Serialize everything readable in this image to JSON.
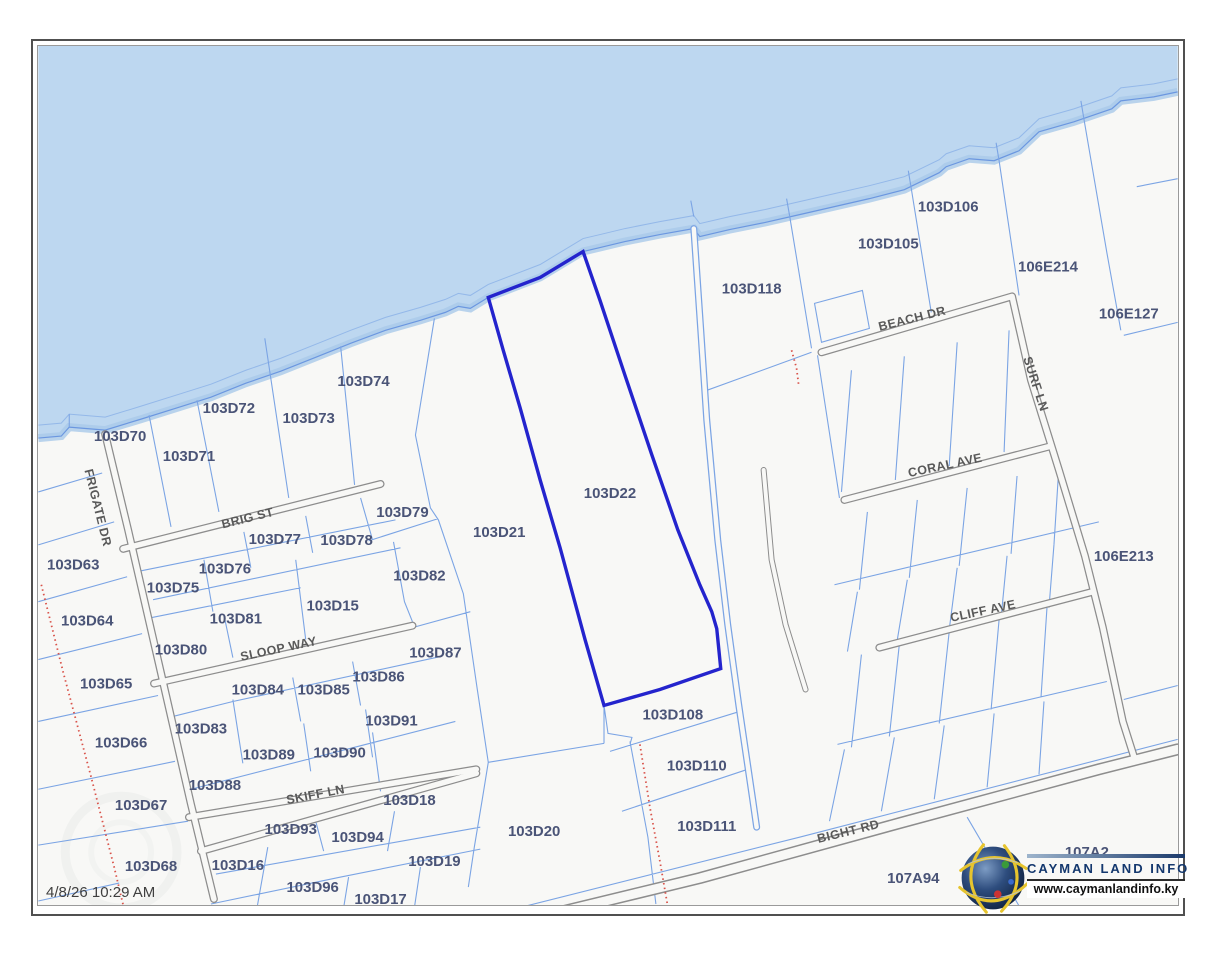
{
  "map": {
    "timestamp": "4/8/26 10:29 AM",
    "highlighted_parcel": "103D22",
    "colors": {
      "water": "#bdd7f0",
      "land": "#f8f8f6",
      "parcel_line": "#7ba4e4",
      "highlight_outline": "#2424cd",
      "road_casing": "#8d8d8d",
      "boundary_dotted": "#d9534a",
      "parcel_label": "#4a5477",
      "road_label": "#595959"
    },
    "parcel_labels": [
      {
        "id": "103D63",
        "x": 72,
        "y": 566
      },
      {
        "id": "103D64",
        "x": 86,
        "y": 622
      },
      {
        "id": "103D65",
        "x": 105,
        "y": 685
      },
      {
        "id": "103D66",
        "x": 120,
        "y": 744
      },
      {
        "id": "103D67",
        "x": 140,
        "y": 807
      },
      {
        "id": "103D68",
        "x": 150,
        "y": 868
      },
      {
        "id": "103D70",
        "x": 119,
        "y": 437
      },
      {
        "id": "103D71",
        "x": 188,
        "y": 457
      },
      {
        "id": "103D72",
        "x": 228,
        "y": 409
      },
      {
        "id": "103D73",
        "x": 308,
        "y": 419
      },
      {
        "id": "103D74",
        "x": 363,
        "y": 382
      },
      {
        "id": "103D75",
        "x": 172,
        "y": 589
      },
      {
        "id": "103D76",
        "x": 224,
        "y": 570
      },
      {
        "id": "103D77",
        "x": 274,
        "y": 540
      },
      {
        "id": "103D78",
        "x": 346,
        "y": 541
      },
      {
        "id": "103D79",
        "x": 402,
        "y": 513
      },
      {
        "id": "103D80",
        "x": 180,
        "y": 651
      },
      {
        "id": "103D81",
        "x": 235,
        "y": 620
      },
      {
        "id": "103D82",
        "x": 419,
        "y": 577
      },
      {
        "id": "103D15",
        "x": 332,
        "y": 607
      },
      {
        "id": "103D87",
        "x": 435,
        "y": 654
      },
      {
        "id": "103D86",
        "x": 378,
        "y": 678
      },
      {
        "id": "103D84",
        "x": 257,
        "y": 691
      },
      {
        "id": "103D85",
        "x": 323,
        "y": 691
      },
      {
        "id": "103D91",
        "x": 391,
        "y": 722
      },
      {
        "id": "103D83",
        "x": 200,
        "y": 730
      },
      {
        "id": "103D89",
        "x": 268,
        "y": 756
      },
      {
        "id": "103D90",
        "x": 339,
        "y": 754
      },
      {
        "id": "103D88",
        "x": 214,
        "y": 787
      },
      {
        "id": "103D18",
        "x": 409,
        "y": 802
      },
      {
        "id": "103D93",
        "x": 290,
        "y": 831
      },
      {
        "id": "103D94",
        "x": 357,
        "y": 839
      },
      {
        "id": "103D16",
        "x": 237,
        "y": 867
      },
      {
        "id": "103D19",
        "x": 434,
        "y": 863
      },
      {
        "id": "103D96",
        "x": 312,
        "y": 889
      },
      {
        "id": "103D17",
        "x": 380,
        "y": 901
      },
      {
        "id": "103D21",
        "x": 499,
        "y": 533
      },
      {
        "id": "103D22",
        "x": 610,
        "y": 494
      },
      {
        "id": "103D20",
        "x": 534,
        "y": 833
      },
      {
        "id": "103D108",
        "x": 673,
        "y": 716
      },
      {
        "id": "103D110",
        "x": 697,
        "y": 767
      },
      {
        "id": "103D111",
        "x": 707,
        "y": 828
      },
      {
        "id": "103D118",
        "x": 752,
        "y": 289
      },
      {
        "id": "103D105",
        "x": 889,
        "y": 244
      },
      {
        "id": "103D106",
        "x": 949,
        "y": 207
      },
      {
        "id": "106E214",
        "x": 1049,
        "y": 267
      },
      {
        "id": "106E127",
        "x": 1130,
        "y": 314
      },
      {
        "id": "106E213",
        "x": 1125,
        "y": 557
      },
      {
        "id": "107A94",
        "x": 914,
        "y": 880
      },
      {
        "id": "107A2",
        "x": 1088,
        "y": 854
      }
    ],
    "road_labels": [
      {
        "name": "FRIGATE DR",
        "x": 96,
        "y": 508,
        "angle": 76
      },
      {
        "name": "BRIG ST",
        "x": 247,
        "y": 519,
        "angle": -14
      },
      {
        "name": "SLOOP WAY",
        "x": 278,
        "y": 650,
        "angle": -12
      },
      {
        "name": "SKIFF LN",
        "x": 315,
        "y": 796,
        "angle": -11
      },
      {
        "name": "BEACH DR",
        "x": 913,
        "y": 319,
        "angle": -14
      },
      {
        "name": "SURF LN",
        "x": 1036,
        "y": 384,
        "angle": 72
      },
      {
        "name": "CORAL AVE",
        "x": 946,
        "y": 466,
        "angle": -12
      },
      {
        "name": "CLIFF AVE",
        "x": 984,
        "y": 612,
        "angle": -12
      },
      {
        "name": "BIGHT RD",
        "x": 849,
        "y": 833,
        "angle": -14
      }
    ]
  },
  "logo": {
    "title": "CAYMAN LAND INFO",
    "website": "www.caymanlandinfo.ky",
    "icon": "globe-icon"
  }
}
